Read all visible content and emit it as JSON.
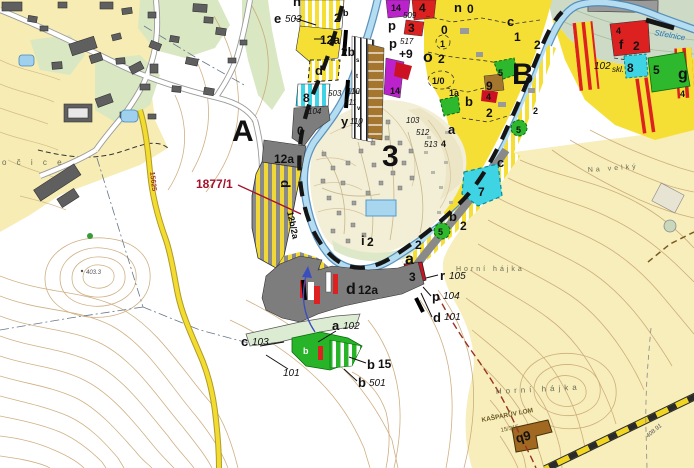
{
  "map": {
    "colors": {
      "river_fill": "#b5ddf2",
      "river_edge": "#4a87b8",
      "bright_yellow": "#f6df35",
      "pale_terrain": "#f7eebc",
      "campsite_cream": "#f3eed6",
      "woodland": "#ccdac6",
      "parcel_green": "#2eb82e",
      "parcel_cyan": "#3fd4e4",
      "parcel_red": "#dd2020",
      "parcel_purple": "#bb22cc",
      "parcel_brown": "#a5762e",
      "parcel_gray": "#7d7d7d",
      "road_yellow": "#f2dc30",
      "boundary_black": "#151515",
      "cadastral_red": "#993322",
      "label_red": "#a3112a",
      "contour": "#c7a26e"
    },
    "labels": [
      {
        "id": "region-a",
        "text": "A",
        "x": 232,
        "y": 141,
        "cls": "big"
      },
      {
        "id": "region-b",
        "text": "B",
        "x": 512,
        "y": 84,
        "cls": "big"
      },
      {
        "id": "region-3",
        "text": "3",
        "x": 382,
        "y": 166,
        "cls": "big"
      },
      {
        "id": "parcel-1877-1",
        "text": "1877/1",
        "x": 196,
        "y": 188,
        "cls": "red"
      },
      {
        "id": "e",
        "text": "e",
        "x": 274,
        "y": 23,
        "cls": "ltr"
      },
      {
        "id": "e-503",
        "text": "503",
        "x": 285,
        "y": 22,
        "cls": "it"
      },
      {
        "id": "n-top",
        "text": "n",
        "x": 293,
        "y": 6,
        "cls": "ltr"
      },
      {
        "id": "2b-sup-2",
        "text": "2",
        "x": 334,
        "y": 22,
        "cls": "num"
      },
      {
        "id": "2b-sup-b",
        "text": "b",
        "x": 343,
        "y": 16,
        "cls": "numS"
      },
      {
        "id": "12a-upper",
        "text": "12a",
        "x": 320,
        "y": 44,
        "cls": "num"
      },
      {
        "id": "2b-lower",
        "text": "2b",
        "x": 341,
        "y": 56,
        "cls": "num"
      },
      {
        "id": "d-upper",
        "text": "d",
        "x": 315,
        "y": 75,
        "cls": "ltr"
      },
      {
        "id": "8-strip",
        "text": "8",
        "x": 303,
        "y": 102,
        "cls": "num"
      },
      {
        "id": "503-strip",
        "text": "503",
        "x": 328,
        "y": 96,
        "cls": "itS"
      },
      {
        "id": "110-strip",
        "text": "110",
        "x": 347,
        "y": 94,
        "cls": "itS"
      },
      {
        "id": "511-strip",
        "text": "511",
        "x": 344,
        "y": 105,
        "cls": "itS"
      },
      {
        "id": "104-strip",
        "text": "104",
        "x": 308,
        "y": 114,
        "cls": "itS"
      },
      {
        "id": "y",
        "text": "y",
        "x": 341,
        "y": 126,
        "cls": "ltr"
      },
      {
        "id": "y-110",
        "text": "110",
        "x": 350,
        "y": 124,
        "cls": "itS"
      },
      {
        "id": "0-gray",
        "text": "0",
        "x": 297,
        "y": 135,
        "cls": "num"
      },
      {
        "id": "12a-gray",
        "text": "12a",
        "x": 274,
        "y": 163,
        "cls": "num"
      },
      {
        "id": "d-rot",
        "text": "d",
        "x": 281,
        "y": 180,
        "cls": "ltr",
        "rot": 90
      },
      {
        "id": "12b-2a",
        "text": "12b/2a",
        "x": 287,
        "y": 212,
        "cls": "numS",
        "rot": 78
      },
      {
        "id": "509",
        "text": "509",
        "x": 403,
        "y": 18,
        "cls": "itS"
      },
      {
        "id": "p-1",
        "text": "p",
        "x": 388,
        "y": 30,
        "cls": "ltr"
      },
      {
        "id": "p-2",
        "text": "p",
        "x": 389,
        "y": 48,
        "cls": "ltr"
      },
      {
        "id": "517",
        "text": "517",
        "x": 400,
        "y": 44,
        "cls": "itS"
      },
      {
        "id": "plus9",
        "text": "+9",
        "x": 399,
        "y": 58,
        "cls": "num"
      },
      {
        "id": "o",
        "text": "o",
        "x": 423,
        "y": 62,
        "cls": "ltr2"
      },
      {
        "id": "o-2",
        "text": "2",
        "x": 438,
        "y": 63,
        "cls": "num"
      },
      {
        "id": "14-top",
        "text": "14",
        "x": 391,
        "y": 11,
        "cls": "numS"
      },
      {
        "id": "4-top",
        "text": "4",
        "x": 419,
        "y": 12,
        "cls": "num"
      },
      {
        "id": "3-red-top",
        "text": "3",
        "x": 408,
        "y": 32,
        "cls": "num"
      },
      {
        "id": "n-ne",
        "text": "n",
        "x": 454,
        "y": 12,
        "cls": "ltr"
      },
      {
        "id": "n-0",
        "text": "0",
        "x": 467,
        "y": 13,
        "cls": "num"
      },
      {
        "id": "0-yellow",
        "text": "0",
        "x": 441,
        "y": 34,
        "cls": "num"
      },
      {
        "id": "1-circle",
        "text": "1",
        "x": 440,
        "y": 47,
        "cls": "numS"
      },
      {
        "id": "1-0",
        "text": "1/0",
        "x": 432,
        "y": 84,
        "cls": "numS"
      },
      {
        "id": "1a",
        "text": "1a",
        "x": 449,
        "y": 96,
        "cls": "numS"
      },
      {
        "id": "14-low",
        "text": "14",
        "x": 390,
        "y": 94,
        "cls": "numS"
      },
      {
        "id": "c-ne",
        "text": "c",
        "x": 507,
        "y": 26,
        "cls": "ltr"
      },
      {
        "id": "1-ne",
        "text": "1",
        "x": 514,
        "y": 41,
        "cls": "num"
      },
      {
        "id": "2-ne1",
        "text": "2",
        "x": 534,
        "y": 49,
        "cls": "num"
      },
      {
        "id": "5-ne",
        "text": "5",
        "x": 498,
        "y": 76,
        "cls": "numS"
      },
      {
        "id": "9-brown",
        "text": "9",
        "x": 486,
        "y": 90,
        "cls": "num"
      },
      {
        "id": "b-ne",
        "text": "b",
        "x": 465,
        "y": 106,
        "cls": "ltr"
      },
      {
        "id": "4-crimson",
        "text": "4",
        "x": 486,
        "y": 100,
        "cls": "numS"
      },
      {
        "id": "2-ne2",
        "text": "2",
        "x": 486,
        "y": 117,
        "cls": "num"
      },
      {
        "id": "2-ne3",
        "text": "2",
        "x": 533,
        "y": 114,
        "cls": "numS"
      },
      {
        "id": "5-circle-b",
        "text": "5",
        "x": 516,
        "y": 133,
        "cls": "numS"
      },
      {
        "id": "a-ne",
        "text": "a",
        "x": 448,
        "y": 134,
        "cls": "ltr"
      },
      {
        "id": "103-camp",
        "text": "103",
        "x": 406,
        "y": 123,
        "cls": "itS"
      },
      {
        "id": "512-camp",
        "text": "512",
        "x": 416,
        "y": 135,
        "cls": "itS"
      },
      {
        "id": "513-camp",
        "text": "513",
        "x": 424,
        "y": 147,
        "cls": "itS"
      },
      {
        "id": "4-camp",
        "text": "4",
        "x": 441,
        "y": 147,
        "cls": "numS"
      },
      {
        "id": "102-skl",
        "text": "102",
        "x": 594,
        "y": 69,
        "cls": "it"
      },
      {
        "id": "skl",
        "text": "skl.",
        "x": 612,
        "y": 72,
        "cls": "itS"
      },
      {
        "id": "f",
        "text": "f",
        "x": 619,
        "y": 49,
        "cls": "ltr"
      },
      {
        "id": "4-f",
        "text": "4",
        "x": 616,
        "y": 34,
        "cls": "numS"
      },
      {
        "id": "2-f",
        "text": "2",
        "x": 633,
        "y": 50,
        "cls": "num"
      },
      {
        "id": "8-cyan-e",
        "text": "8",
        "x": 627,
        "y": 72,
        "cls": "num"
      },
      {
        "id": "5-green-e",
        "text": "5",
        "x": 653,
        "y": 74,
        "cls": "num"
      },
      {
        "id": "g",
        "text": "g",
        "x": 678,
        "y": 79,
        "cls": "ltr2"
      },
      {
        "id": "4-g",
        "text": "4",
        "x": 680,
        "y": 97,
        "cls": "numS"
      },
      {
        "id": "c-east",
        "text": "c",
        "x": 497,
        "y": 167,
        "cls": "ltr"
      },
      {
        "id": "7-cyan",
        "text": "7",
        "x": 478,
        "y": 196,
        "cls": "num"
      },
      {
        "id": "b-east",
        "text": "b",
        "x": 449,
        "y": 221,
        "cls": "ltr"
      },
      {
        "id": "2-beast",
        "text": "2",
        "x": 460,
        "y": 230,
        "cls": "num"
      },
      {
        "id": "5-circle-e",
        "text": "5",
        "x": 438,
        "y": 235,
        "cls": "numS"
      },
      {
        "id": "2-east2",
        "text": "2",
        "x": 415,
        "y": 249,
        "cls": "num"
      },
      {
        "id": "a-ford",
        "text": "a",
        "x": 405,
        "y": 264,
        "cls": "ltr2"
      },
      {
        "id": "3-ford",
        "text": "3",
        "x": 409,
        "y": 281,
        "cls": "num"
      },
      {
        "id": "r",
        "text": "r",
        "x": 440,
        "y": 280,
        "cls": "ltr"
      },
      {
        "id": "r-105",
        "text": "105",
        "x": 449,
        "y": 279,
        "cls": "it"
      },
      {
        "id": "p-3",
        "text": "p",
        "x": 432,
        "y": 301,
        "cls": "ltr"
      },
      {
        "id": "p-104",
        "text": "104",
        "x": 443,
        "y": 299,
        "cls": "it"
      },
      {
        "id": "d-s",
        "text": "d",
        "x": 433,
        "y": 322,
        "cls": "ltr"
      },
      {
        "id": "d-101",
        "text": "101",
        "x": 444,
        "y": 320,
        "cls": "it"
      },
      {
        "id": "i",
        "text": "i",
        "x": 361,
        "y": 245,
        "cls": "ltr"
      },
      {
        "id": "i-2",
        "text": "2",
        "x": 367,
        "y": 246,
        "cls": "num"
      },
      {
        "id": "d-12a",
        "text": "d",
        "x": 346,
        "y": 294,
        "cls": "ltr2"
      },
      {
        "id": "d12a-num",
        "text": "12a",
        "x": 358,
        "y": 294,
        "cls": "num"
      },
      {
        "id": "a-s",
        "text": "a",
        "x": 332,
        "y": 330,
        "cls": "ltr"
      },
      {
        "id": "a-102",
        "text": "102",
        "x": 343,
        "y": 329,
        "cls": "it"
      },
      {
        "id": "c-s",
        "text": "c",
        "x": 241,
        "y": 346,
        "cls": "ltr"
      },
      {
        "id": "c-103",
        "text": "103",
        "x": 252,
        "y": 345,
        "cls": "it"
      },
      {
        "id": "101-s",
        "text": "101",
        "x": 283,
        "y": 376,
        "cls": "it"
      },
      {
        "id": "b-15l",
        "text": "b",
        "x": 367,
        "y": 369,
        "cls": "ltr"
      },
      {
        "id": "b-15",
        "text": "15",
        "x": 378,
        "y": 368,
        "cls": "num"
      },
      {
        "id": "b-501l",
        "text": "b",
        "x": 358,
        "y": 387,
        "cls": "ltr"
      },
      {
        "id": "b-501",
        "text": "501",
        "x": 369,
        "y": 386,
        "cls": "it"
      },
      {
        "id": "b-green",
        "text": "b",
        "x": 303,
        "y": 354,
        "cls": "white"
      },
      {
        "id": "ocice",
        "text": "o č i c e",
        "x": 2,
        "y": 165,
        "cls": "place"
      },
      {
        "id": "na-velky",
        "text": "Na velký",
        "x": 588,
        "y": 172,
        "cls": "placeS",
        "rot": -4
      },
      {
        "id": "horni-hajka-1",
        "text": "Horní hájka",
        "x": 456,
        "y": 271,
        "cls": "placeS"
      },
      {
        "id": "horni-hajka-2",
        "text": "Horní hájka",
        "x": 496,
        "y": 394,
        "cls": "place",
        "rot": -3
      },
      {
        "id": "strelnice",
        "text": "Střelnice",
        "x": 654,
        "y": 35,
        "cls": "river",
        "rot": 10
      },
      {
        "id": "road-15625",
        "text": "15625",
        "x": 150,
        "y": 172,
        "cls": "roadnum",
        "rot": 83
      },
      {
        "id": "spot-403",
        "text": "403.3",
        "x": 86,
        "y": 274,
        "cls": "tiny"
      },
      {
        "id": "spot-408",
        "text": "408.91",
        "x": 648,
        "y": 438,
        "cls": "tiny",
        "rot": -40
      },
      {
        "id": "q9",
        "text": "q9",
        "x": 517,
        "y": 443,
        "cls": "ltr",
        "rot": -15
      },
      {
        "id": "kasparuv-lom",
        "text": "KAŠPARŮV LOM",
        "x": 482,
        "y": 422,
        "cls": "quarry",
        "rot": -11
      },
      {
        "id": "15-315",
        "text": "15/315",
        "x": 501,
        "y": 432,
        "cls": "quarryS",
        "rot": -11
      },
      {
        "id": "cell-s",
        "text": "s",
        "x": 356,
        "y": 62,
        "cls": "tinyB"
      },
      {
        "id": "cell-t",
        "text": "t",
        "x": 356,
        "y": 78,
        "cls": "tinyB"
      },
      {
        "id": "cell-u",
        "text": "u",
        "x": 356,
        "y": 94,
        "cls": "tinyB"
      },
      {
        "id": "cell-v",
        "text": "v",
        "x": 357,
        "y": 110,
        "cls": "tinyB"
      },
      {
        "id": "cell-x",
        "text": "x",
        "x": 357,
        "y": 127,
        "cls": "tinyB"
      }
    ]
  }
}
